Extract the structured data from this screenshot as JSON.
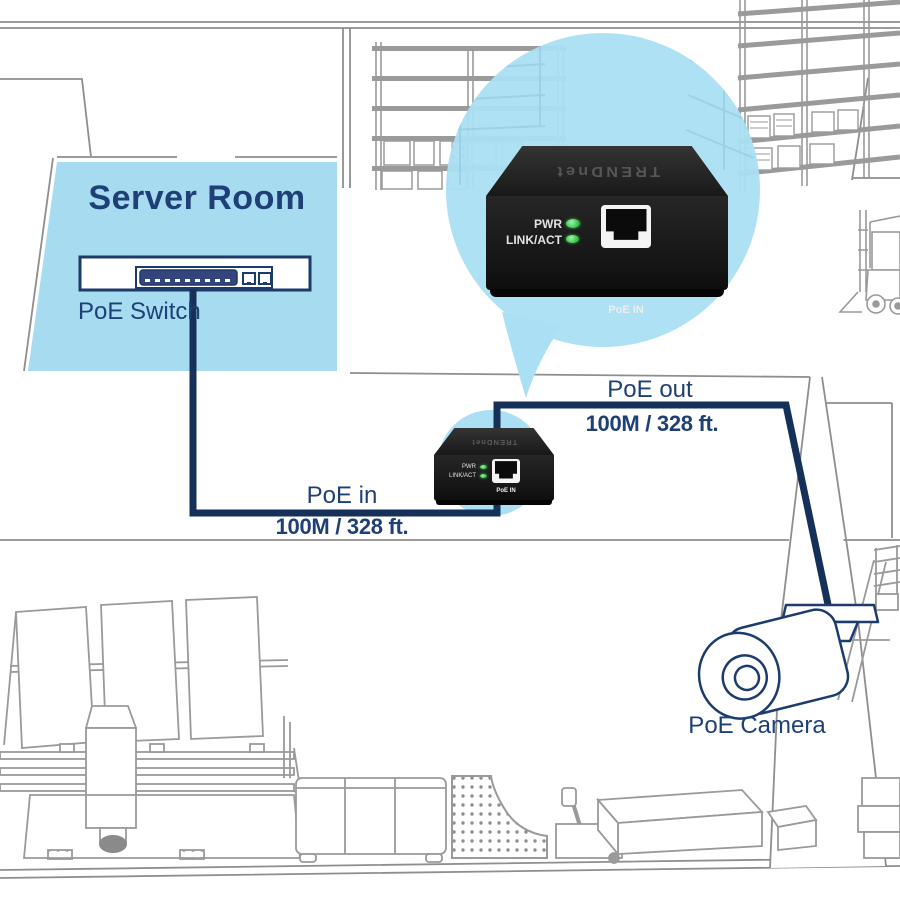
{
  "scene": {
    "server_room": {
      "title": "Server Room",
      "switch_label": "PoE Switch"
    },
    "links": {
      "poe_in": {
        "label": "PoE in",
        "distance": "100M / 328 ft."
      },
      "poe_out": {
        "label": "PoE out",
        "distance": "100M / 328 ft."
      }
    },
    "camera": {
      "label": "PoE Camera"
    },
    "extender": {
      "brand": "TRENDnet",
      "pwr": "PWR",
      "link_act": "LINK/ACT",
      "port": "PoE IN"
    },
    "colors": {
      "navy_text": "#1e4077",
      "cable_navy": "#153059",
      "room_blue": "#a7dbf0",
      "bubble_blue": "#abdff3",
      "led_green": "#37c44a",
      "line_art_gray": "#9a9a9a"
    }
  }
}
